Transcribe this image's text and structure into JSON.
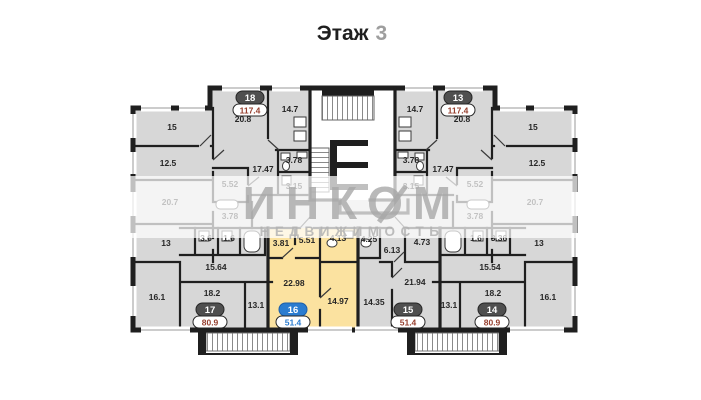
{
  "title": {
    "label": "Этаж",
    "floor_number": "3"
  },
  "watermark": {
    "brand": "ИНКОМ",
    "subtitle": "НЕДВИЖИМОСТЬ"
  },
  "colors": {
    "wall": "#1f1f1f",
    "room_fill": "#d7d7d7",
    "selected_fill": "#fbe2a0",
    "selected_accent": "#2a7cd0",
    "badge_dark": "#4f4f4f",
    "area_text": "#963f2e",
    "watermark_gray": "#a8a8a8"
  },
  "apartments": {
    "apt18": {
      "number": "18",
      "area": "117.4",
      "selected": false,
      "rooms": [
        "15",
        "20.8",
        "14.7",
        "12.5",
        "17.47",
        "5.52",
        "3.78",
        "3.15"
      ]
    },
    "apt17": {
      "number": "17",
      "area": "80.9",
      "selected": false,
      "rooms": [
        "20.7",
        "13",
        "3.78",
        "3.6",
        "1.6",
        "15.64",
        "16.1",
        "18.2",
        "13.1"
      ]
    },
    "apt16": {
      "number": "16",
      "area": "51.4",
      "selected": true,
      "rooms": [
        "3.81",
        "5.51",
        "4.13",
        "22.98",
        "14.97"
      ]
    },
    "apt15": {
      "number": "15",
      "area": "51.4",
      "selected": false,
      "rooms": [
        "4.25",
        "6.13",
        "4.73",
        "21.94",
        "14.35"
      ]
    },
    "apt13": {
      "number": "13",
      "area": "117.4",
      "selected": false,
      "rooms": [
        "14.7",
        "20.8",
        "15",
        "3.78",
        "17.47",
        "12.5",
        "5.52",
        "3.15"
      ]
    },
    "apt14": {
      "number": "14",
      "area": "80.9",
      "selected": false,
      "rooms": [
        "3.78",
        "20.7",
        "13",
        "1.6",
        "3.36",
        "15.54",
        "13.1",
        "18.2",
        "16.1"
      ]
    }
  }
}
